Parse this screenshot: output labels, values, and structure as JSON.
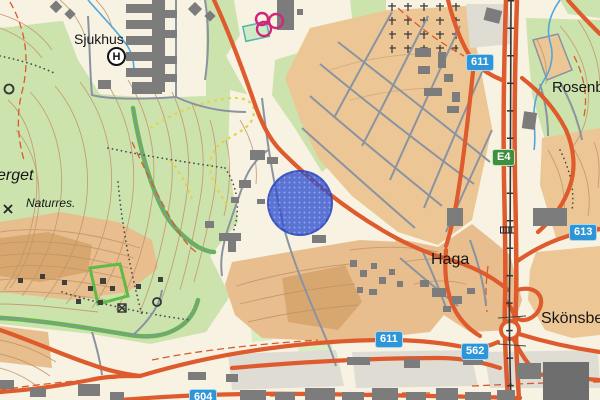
{
  "map": {
    "type": "topographic-street-map",
    "place_labels": [
      {
        "id": "sjukhus",
        "text": "Sjukhus"
      },
      {
        "id": "erget",
        "text": "erget"
      },
      {
        "id": "naturres",
        "text": "Naturres."
      },
      {
        "id": "haga",
        "text": "Haga"
      },
      {
        "id": "rosenborg",
        "text": "Rosenborg"
      },
      {
        "id": "skonsberg",
        "text": "Skönsberg"
      }
    ],
    "road_shields": [
      {
        "id": "611-north",
        "text": "611",
        "variant": "blue"
      },
      {
        "id": "e4",
        "text": "E4",
        "variant": "green"
      },
      {
        "id": "613",
        "text": "613",
        "variant": "blue"
      },
      {
        "id": "611-south",
        "text": "611",
        "variant": "blue"
      },
      {
        "id": "562",
        "text": "562",
        "variant": "blue"
      },
      {
        "id": "604",
        "text": "604",
        "variant": "blue"
      }
    ],
    "hospital_symbol": {
      "letter": "H"
    },
    "marker": {
      "shape": "circle",
      "color": "#2F4FCD",
      "center_x": 300,
      "center_y": 203,
      "radius": 33
    },
    "colors": {
      "background": "#F7F2E2",
      "forest": "#CDE3AE",
      "residential": "#ECC795",
      "residential_dark": "#D8A770",
      "industrial": "#DFDCD4",
      "road_major": "#DD5B2D",
      "road_minor": "#8A93A1",
      "water": "#4FA8DC",
      "building": "#7C7C7C",
      "contour": "#C09468",
      "trail_green": "#5DBB46",
      "trail_yellow": "#E3D24B",
      "shield_blue": "#2E96D6",
      "shield_green": "#3F8F3F",
      "marker_blue": "#2F4FCD"
    }
  }
}
